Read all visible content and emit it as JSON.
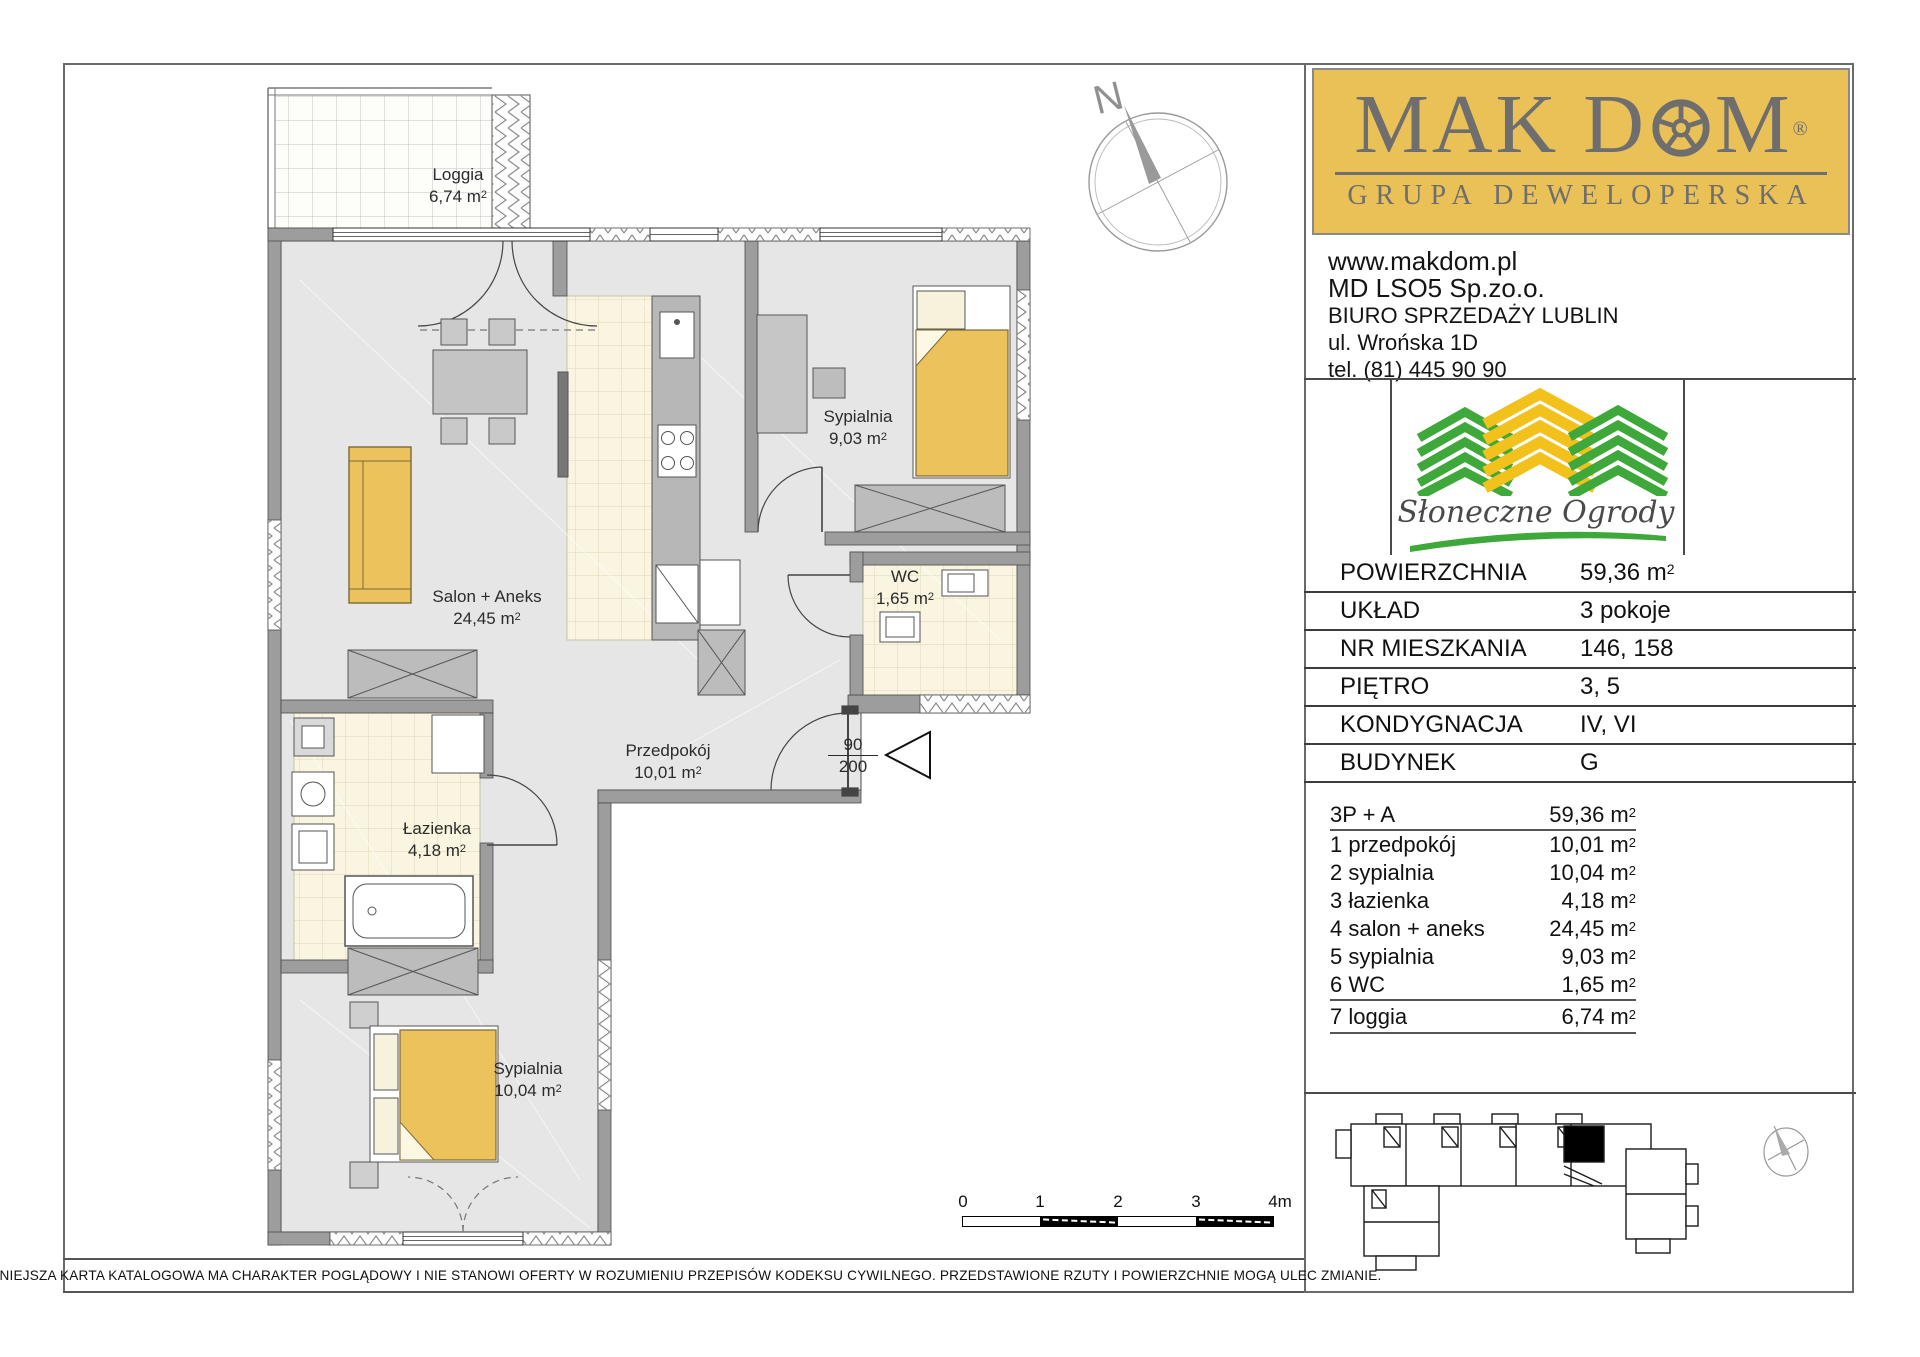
{
  "units": {
    "m": " m",
    "sup": "2"
  },
  "plan": {
    "loggia": {
      "name": "Loggia",
      "area": "6,74"
    },
    "salon": {
      "name": "Salon + Aneks",
      "area": "24,45"
    },
    "bedroom_top": {
      "name": "Sypialnia",
      "area": "9,03"
    },
    "wc": {
      "name": "WC",
      "area": "1,65"
    },
    "hall": {
      "name": "Przedpokój",
      "area": "10,01"
    },
    "bathroom": {
      "name": "Łazienka",
      "area": "4,18"
    },
    "bedroom_bottom": {
      "name": "Sypialnia",
      "area": "10,04"
    },
    "entrance_door": {
      "width": "90",
      "height": "200"
    },
    "compass_label": "N"
  },
  "scalebar": {
    "ticks": [
      "0",
      "1",
      "2",
      "3",
      "4m"
    ]
  },
  "brand": {
    "name_left": "MAK D",
    "name_right": "M",
    "registered": "®",
    "tagline": "GRUPA DEWELOPERSKA",
    "website": "www.makdom.pl",
    "company": "MD LSO5 Sp.zo.o.",
    "office": "BIURO SPRZEDAŻY LUBLIN",
    "street": "ul. Wrońska 1D",
    "phone": "tel. (81) 445 90 90",
    "colors": {
      "brand_yellow": "#E9C157",
      "logo_gray": "#6E6E6E"
    }
  },
  "estate": {
    "name": "Słoneczne Ogrody",
    "colors": {
      "green": "#3EA83A",
      "yellow": "#F2C11C"
    }
  },
  "details": {
    "rows": [
      {
        "label": "POWIERZCHNIA",
        "value": "59,36",
        "unit": true
      },
      {
        "label": "UKŁAD",
        "value": "3 pokoje"
      },
      {
        "label": "NR MIESZKANIA",
        "value": "146, 158"
      },
      {
        "label": "PIĘTRO",
        "value": "3, 5"
      },
      {
        "label": "KONDYGNACJA",
        "value": "IV, VI"
      },
      {
        "label": "BUDYNEK",
        "value": "G"
      }
    ]
  },
  "rooms": {
    "header": {
      "label": "3P + A",
      "value": "59,36"
    },
    "items": [
      {
        "label": "1 przedpokój",
        "value": "10,01"
      },
      {
        "label": "2 sypialnia",
        "value": "10,04"
      },
      {
        "label": "3 łazienka",
        "value": "4,18"
      },
      {
        "label": "4 salon + aneks",
        "value": "24,45"
      },
      {
        "label": "5 sypialnia",
        "value": "9,03"
      },
      {
        "label": "6 WC",
        "value": "1,65"
      },
      {
        "label": "7 loggia",
        "value": "6,74"
      }
    ]
  },
  "disclaimer": "NINIEJSZA KARTA KATALOGOWA MA CHARAKTER POGLĄDOWY I NIE STANOWI OFERTY W ROZUMIENIU PRZEPISÓW KODEKSU CYWILNEGO. PRZEDSTAWIONE RZUTY I POWIERZCHNIE MOGĄ ULEC ZMIANIE.",
  "plan_colors": {
    "wall": "#9D9D9D",
    "floor": "#E6E6E6",
    "tiles": "#F9F5E0",
    "furniture_yellow": "#ECC25D"
  }
}
